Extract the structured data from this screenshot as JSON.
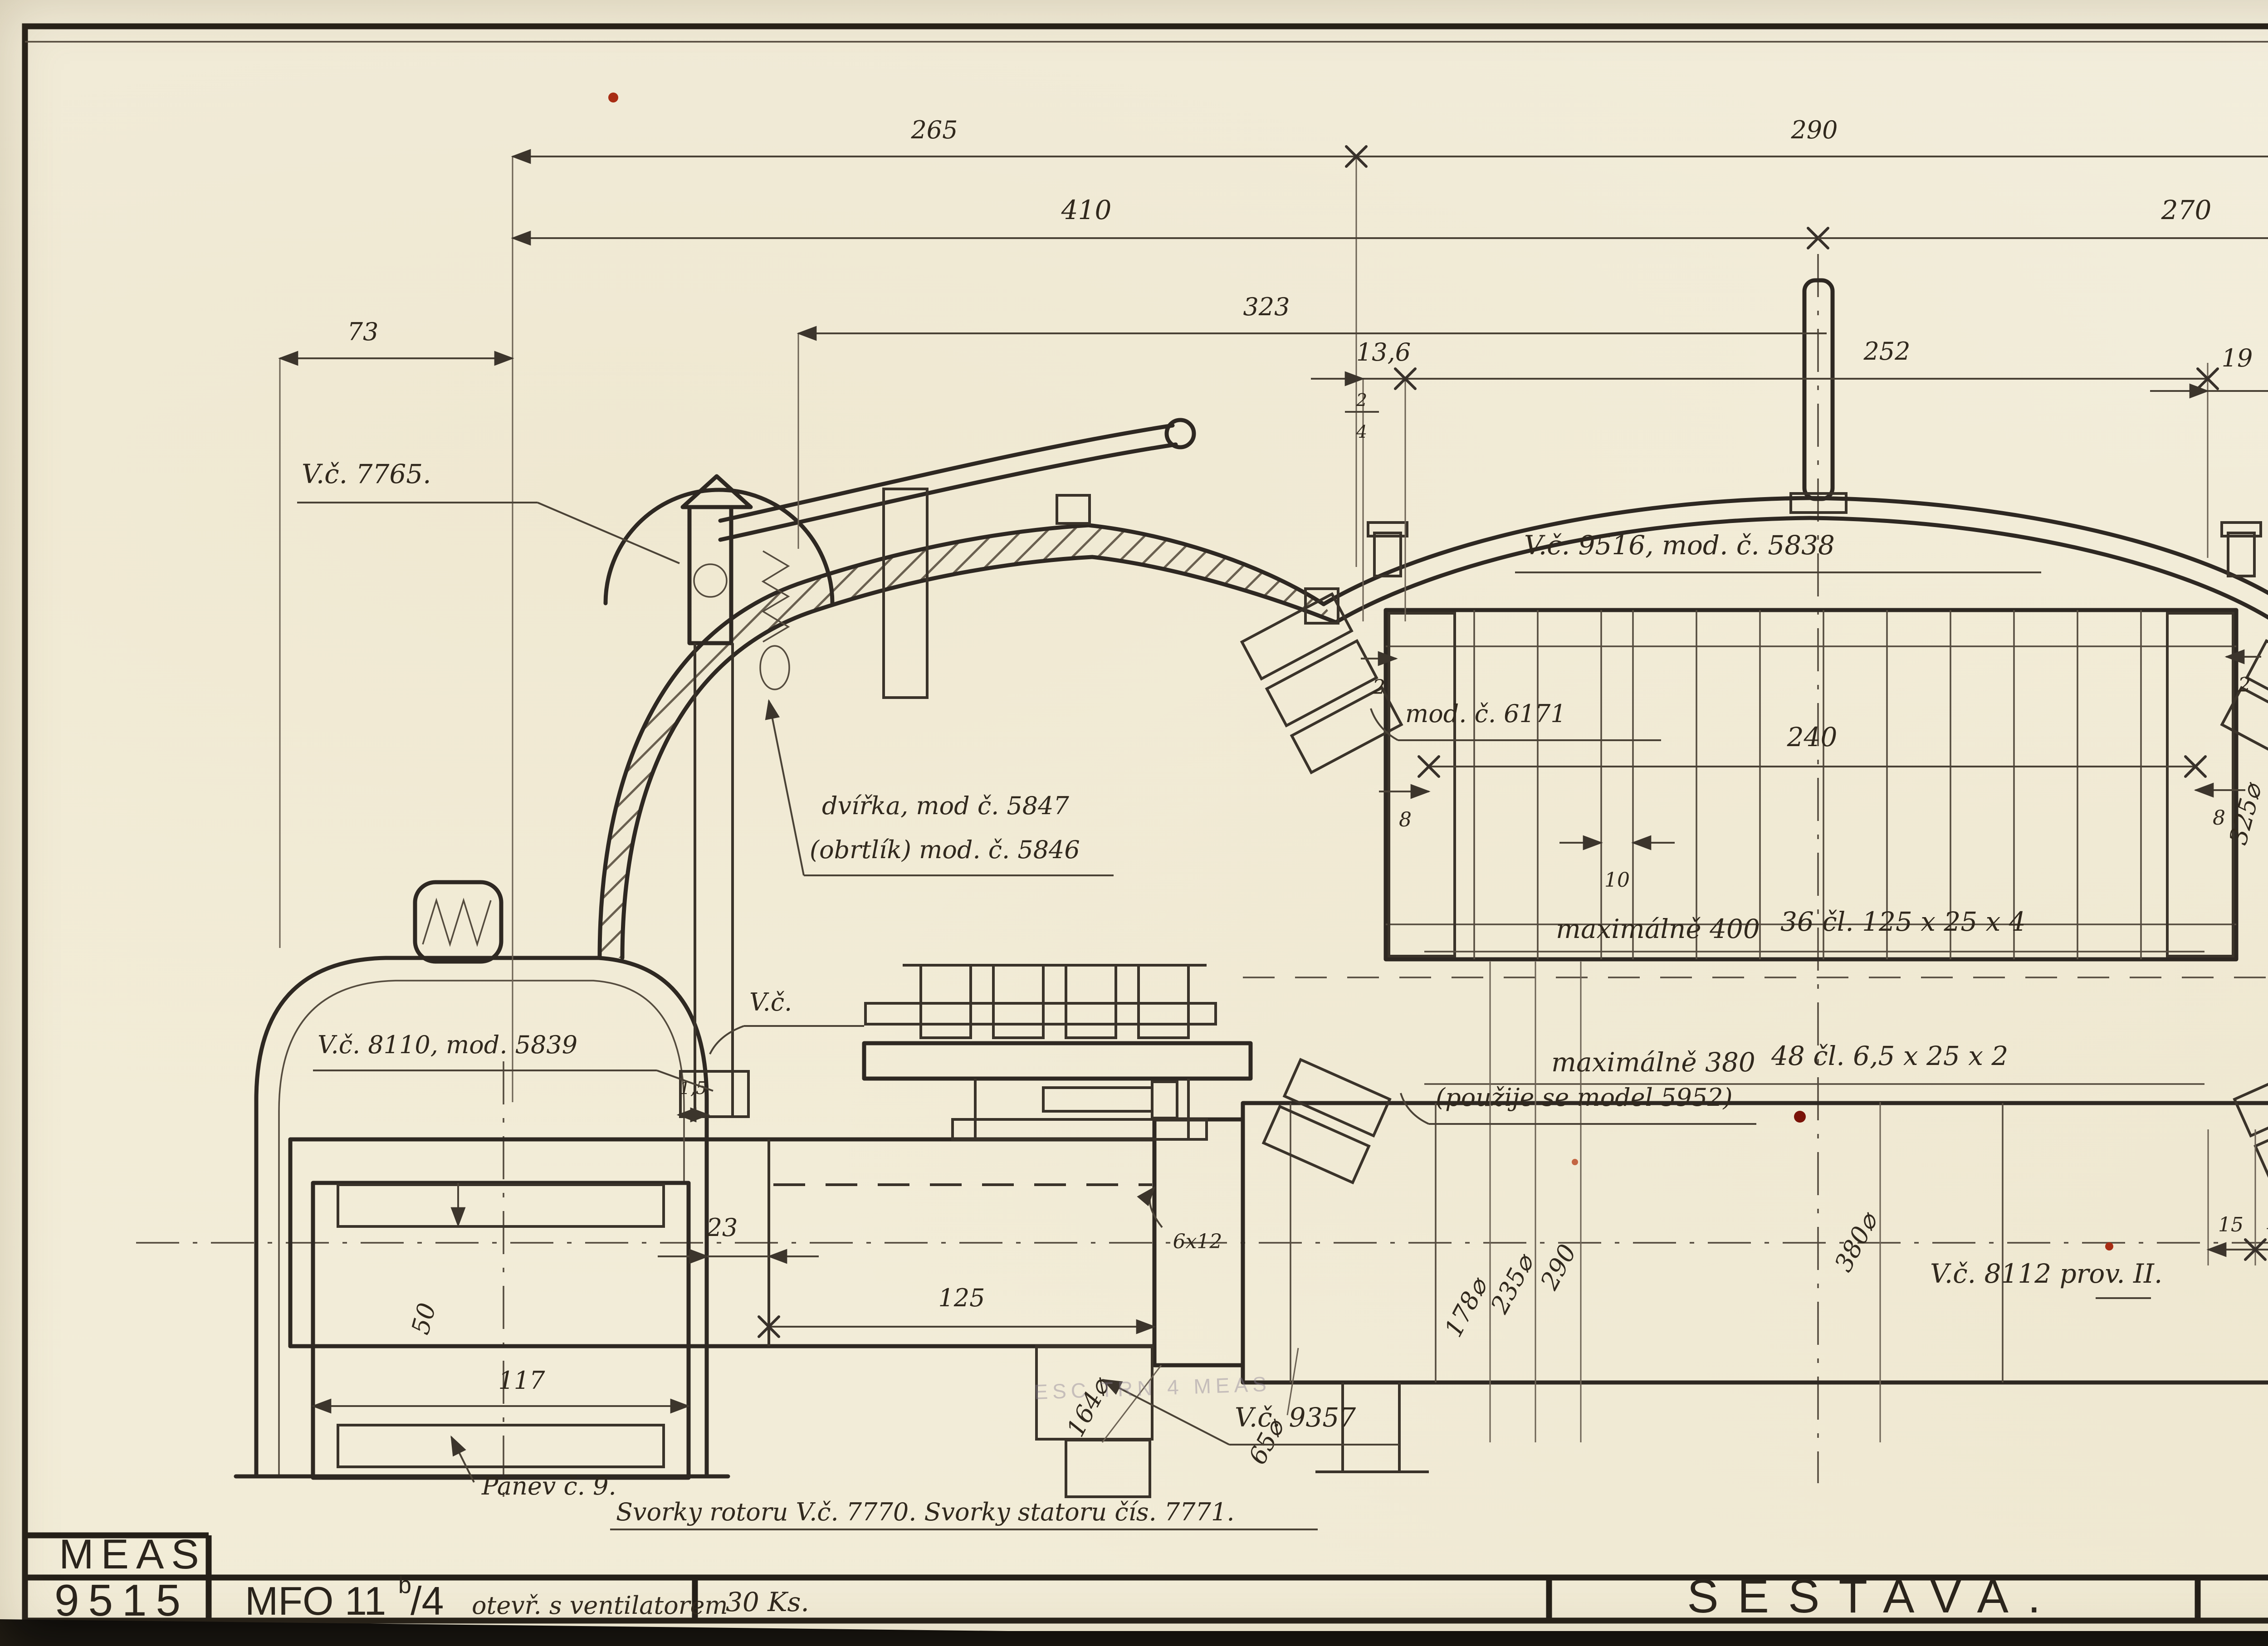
{
  "sheet": {
    "company": "MEAS",
    "drawing_number": "9515",
    "designation_prefix": "MFO 11",
    "designation_sup": "b",
    "designation_suffix": "/4",
    "designation_note": "otevř. s ventilatorem",
    "quantity": "30 Ks.",
    "title": "SESTAVA.",
    "date_note": "Brno 8/III 28 Jl.",
    "bottom_note": "Svorky rotoru V.č. 7770.   Svorky statoru čís. 7771.",
    "stamp": "ESC TRN 4 MEAS",
    "paper_color": "#f3eedd",
    "ink_color": "#30281d"
  },
  "labels": {
    "c7765": "V.č. 7765.",
    "c8110": "V.č. 8110, mod. 5839",
    "dvirka": "dvířka, mod č. 5847",
    "obrtlik": "(obrtlík) mod. č. 5846",
    "vc_small": "V.č.",
    "c9516": "V.č. 9516, mod. č. 5838",
    "c6171": "mod. č. 6171",
    "max400": "maximálně 400",
    "cl36": "36 čl. 125 x 25 x 4",
    "max380": "maximálně 380",
    "cl48": "48 čl. 6,5 x 25 x 2",
    "model5952": "(použije se model 5952)",
    "c8111": "V.č. 8111 mod. č. 5840",
    "c9356": "V.č. 9356",
    "lopatky": "lopatky zeseknuty !",
    "c9357": "V.č. 9357",
    "c8112": "V.č. 8112 prov. II.",
    "panev": "Pánev č. 9."
  },
  "dims": {
    "d265": "265",
    "d290": "290",
    "d125": "125",
    "d163": "163",
    "d410": "410",
    "d270": "270",
    "d323": "323",
    "d73": "73",
    "d13_6": "13,6",
    "d252": "252",
    "d19": "19",
    "frac_top": "2",
    "frac_bot": "4",
    "d240": "240",
    "d10": "10",
    "d8l": "8",
    "d8r": "8",
    "d2l": "2",
    "d2r": "2",
    "d1_5": "1,5",
    "d50l": "50",
    "d117": "117",
    "d23": "23",
    "d125b": "125",
    "d6x12l": "6x12",
    "d164": "164⌀",
    "d65l": "65⌀",
    "d178": "178⌀",
    "d235": "235⌀",
    "d290b": "290",
    "d380": "380⌀",
    "d325": "325⌀",
    "d15": "15",
    "d14": "14",
    "d64_5": "64,5",
    "d28": "28",
    "d65r": "65",
    "d137": "137",
    "d50r": "50",
    "d245": "245⌀",
    "d80": "80",
    "d6x12r": "6x12",
    "d45": "45",
    "d85": "85",
    "d32": "32",
    "d350": "350",
    "d20": "20",
    "d5": "5"
  }
}
